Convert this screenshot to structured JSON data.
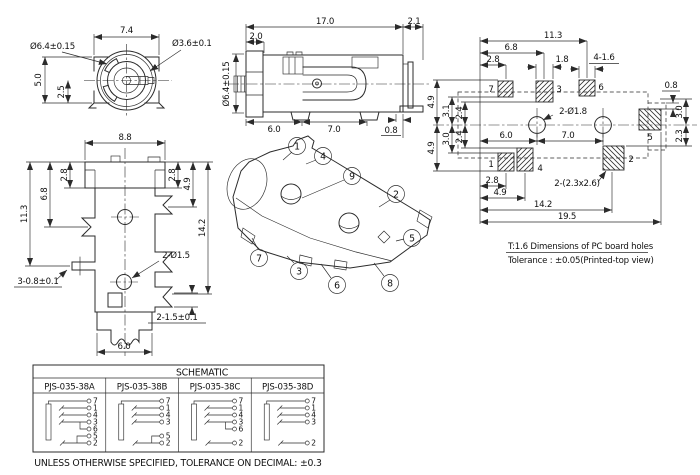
{
  "front_view": {
    "dim_width": "7.4",
    "dim_outer_dia": "Ø6.4±0.15",
    "dim_pin_dia": "Ø3.6±0.1",
    "dim_height": "5.0",
    "dim_half_height": "2.5"
  },
  "side_view": {
    "dim_length": "17.0",
    "dim_pin": "2.1",
    "dim_flange": "2.0",
    "dim_barrel_dia": "Ø6.4±0.15",
    "dim_foot1": "6.0",
    "dim_foot2": "7.0",
    "dim_foot_w": "0.8"
  },
  "pcb_view": {
    "dim_11_3": "11.3",
    "dim_6_8": "6.8",
    "dim_2_8_top": "2.8",
    "dim_1_8": "1.8",
    "dim_slots": "4-1.6",
    "dim_0_8": "0.8",
    "dim_4_9_top": "4.9",
    "dim_3_1": "3.1",
    "dim_2_4_a": "2.4",
    "dim_2_4_b": "2.4",
    "dim_3_0_left": "3.0",
    "dim_4_9_bot": "4.9",
    "dim_holes": "2-Ø1.8",
    "dim_6_0": "6.0",
    "dim_7_0": "7.0",
    "dim_3_0_right": "3.0",
    "dim_2_3": "2.3",
    "dim_2_8_bottom": "2.8",
    "dim_4_9_lower": "4.9",
    "dim_pads": "2-(2.3x2.6)",
    "dim_14_2": "14.2",
    "dim_19_5": "19.5",
    "pads": {
      "p7": "7",
      "p3": "3",
      "p6": "6",
      "p1": "1",
      "p4": "4",
      "p2": "2",
      "p5": "5"
    }
  },
  "bottom_view": {
    "dim_8_8": "8.8",
    "dim_2_8_left": "2.8",
    "dim_2_8_right": "2.8",
    "dim_4_9": "4.9",
    "dim_6_8": "6.8",
    "dim_11_3": "11.3",
    "dim_14_2": "14.2",
    "dim_holes": "2-Ø1.5",
    "dim_pins_left": "3-0.8±0.1",
    "dim_pins_right": "2-1.5±0.1",
    "dim_6_0": "6.0"
  },
  "iso_view": {
    "callouts": [
      "1",
      "4",
      "9",
      "2",
      "5",
      "7",
      "3",
      "6",
      "8"
    ]
  },
  "notes": {
    "line1": "T:1.6 Dimensions of PC board holes",
    "line2": "Tolerance : ±0.05(Printed-top view)"
  },
  "schematic": {
    "title": "SCHEMATIC",
    "variants": [
      {
        "name": "PJS-035-38A",
        "pins": [
          "7",
          "1",
          "4",
          "3",
          "6",
          "5",
          "2"
        ]
      },
      {
        "name": "PJS-035-38B",
        "pins": [
          "7",
          "1",
          "4",
          "3",
          "5",
          "2"
        ]
      },
      {
        "name": "PJS-035-38C",
        "pins": [
          "7",
          "1",
          "4",
          "3",
          "6",
          "2"
        ]
      },
      {
        "name": "PJS-035-38D",
        "pins": [
          "7",
          "1",
          "4",
          "3",
          "2"
        ]
      }
    ]
  },
  "footer_note": "UNLESS OTHERWISE SPECIFIED, TOLERANCE ON DECIMAL: ±0.3"
}
